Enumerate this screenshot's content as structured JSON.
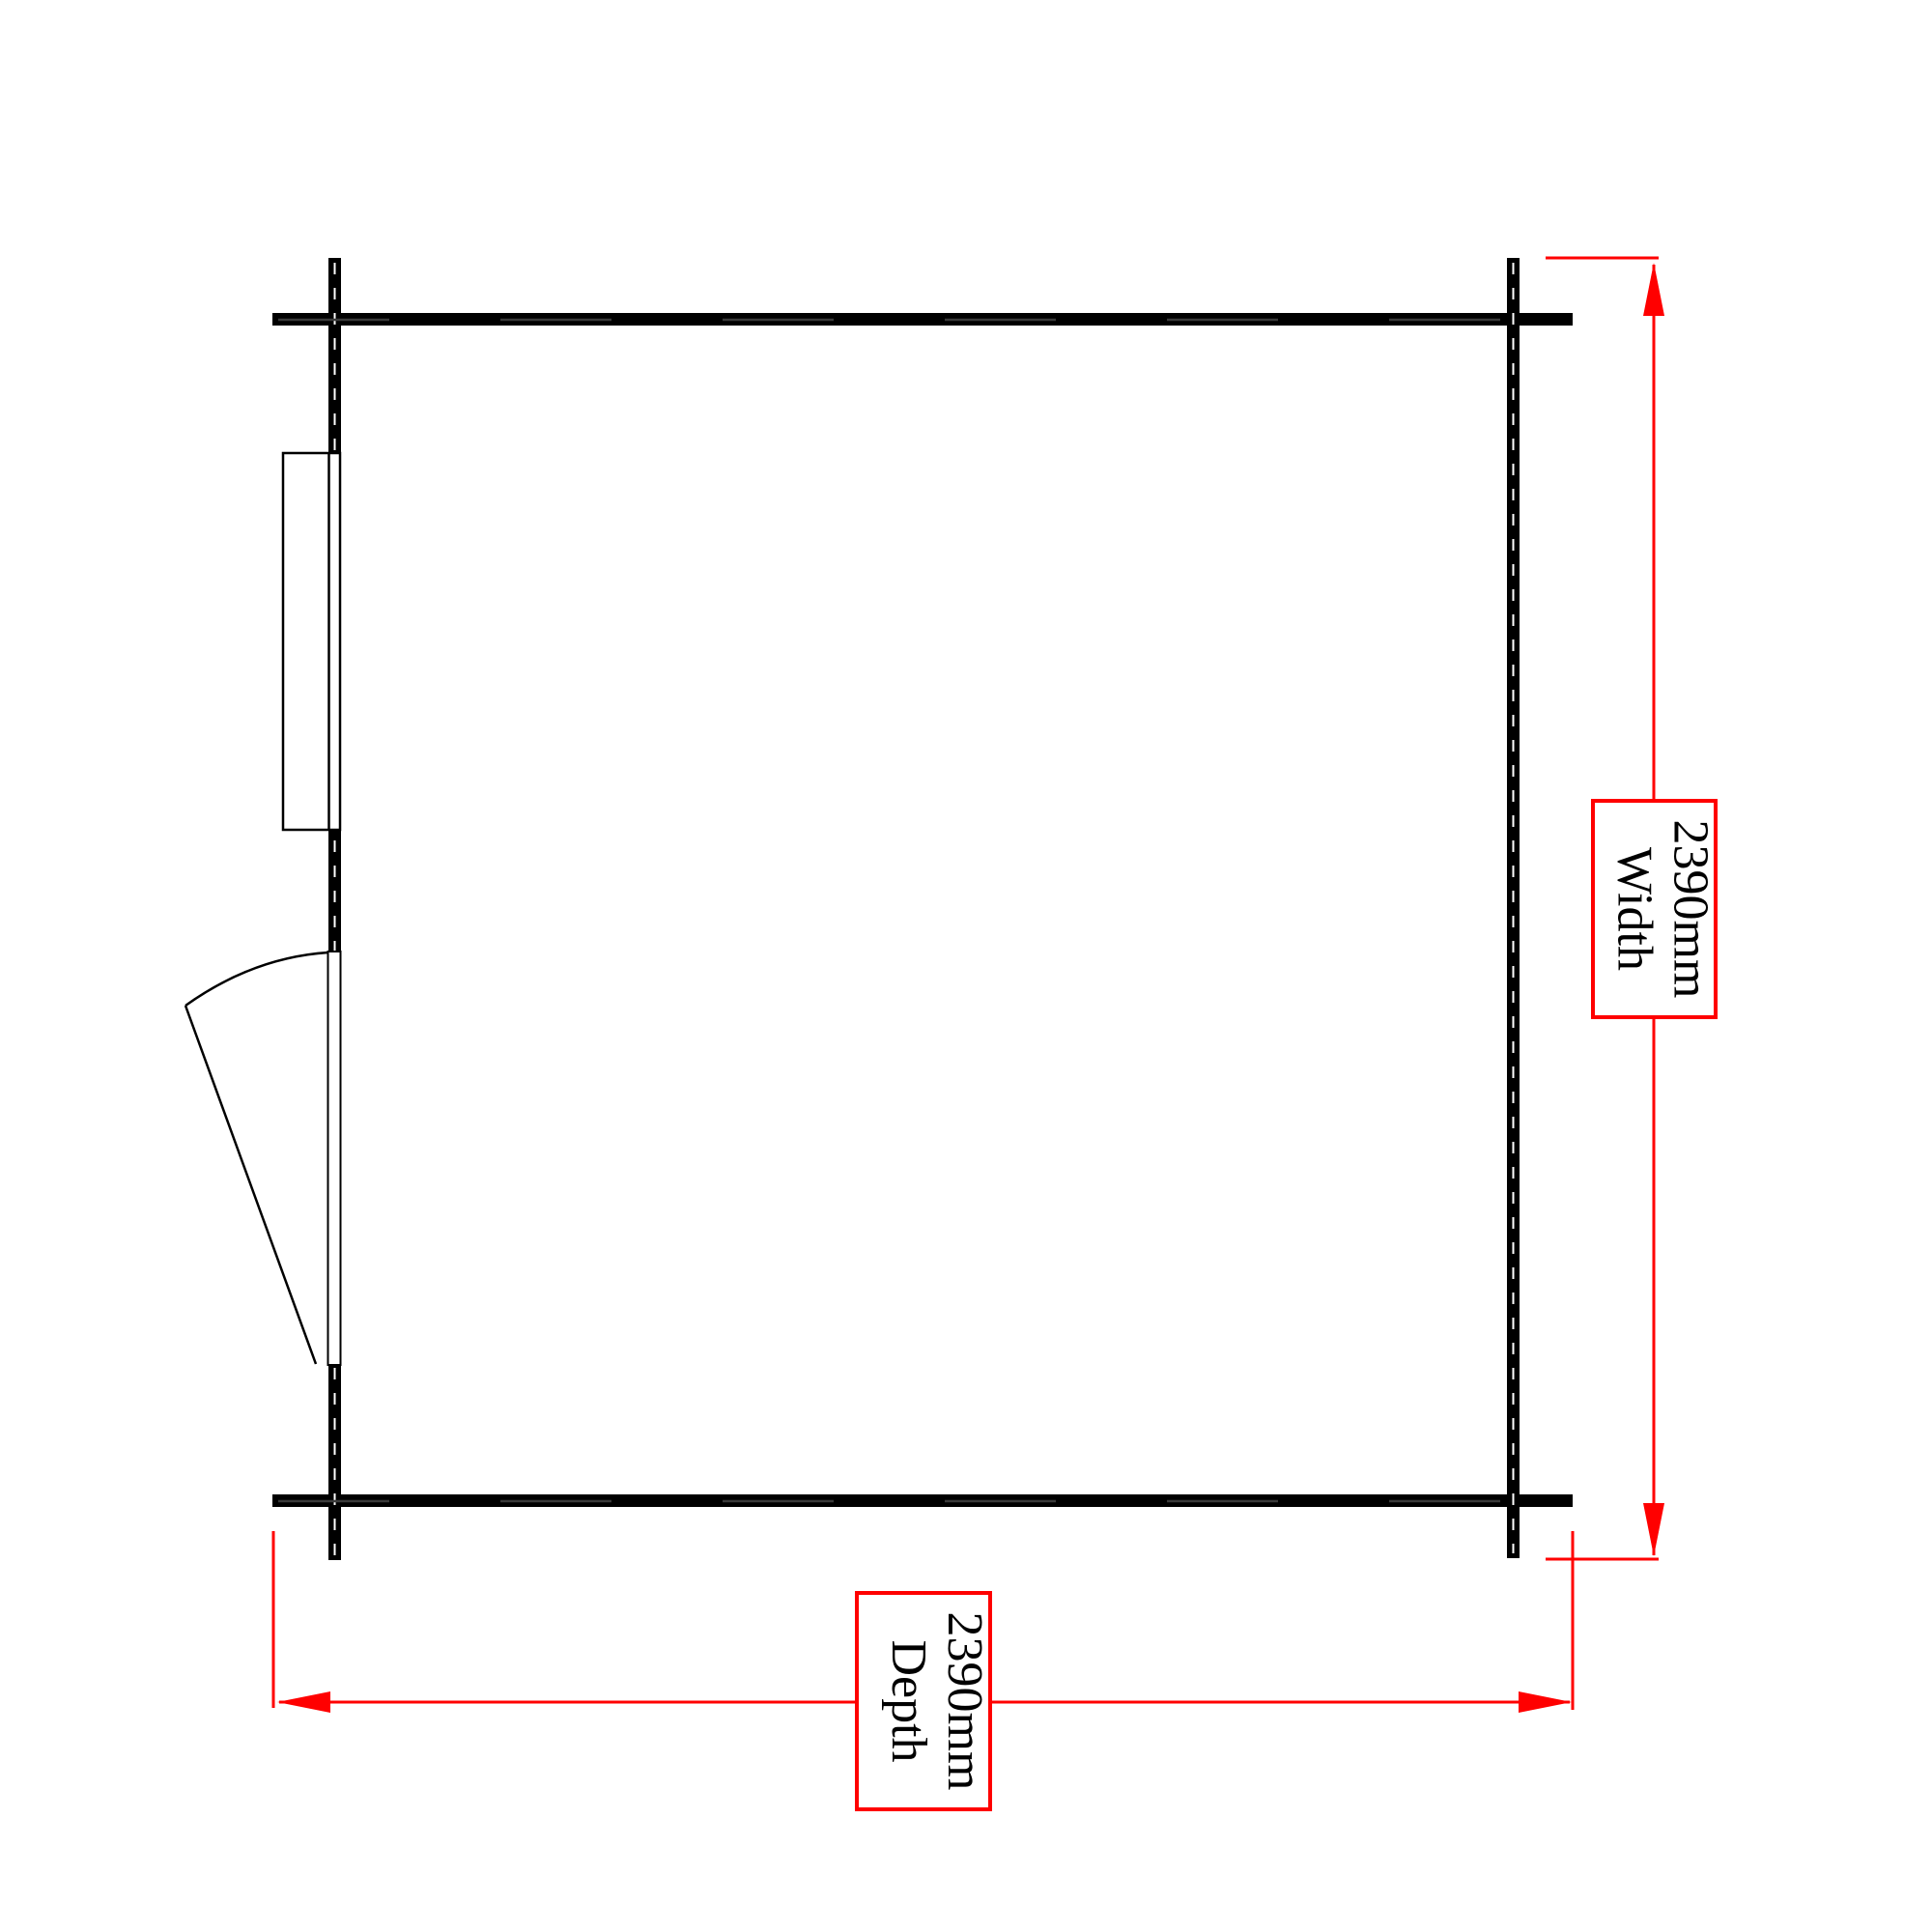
{
  "plan": {
    "type": "floor-plan",
    "labels": {
      "width": {
        "value": "2390mm",
        "caption": "Width"
      },
      "depth": {
        "value": "2390mm",
        "caption": "Depth"
      }
    },
    "colors": {
      "wall": "#000000",
      "dimension": "#ff0000",
      "label_border": "#ff0000",
      "label_background": "#ffffff",
      "label_text": "#000000",
      "background": "#ffffff"
    }
  }
}
